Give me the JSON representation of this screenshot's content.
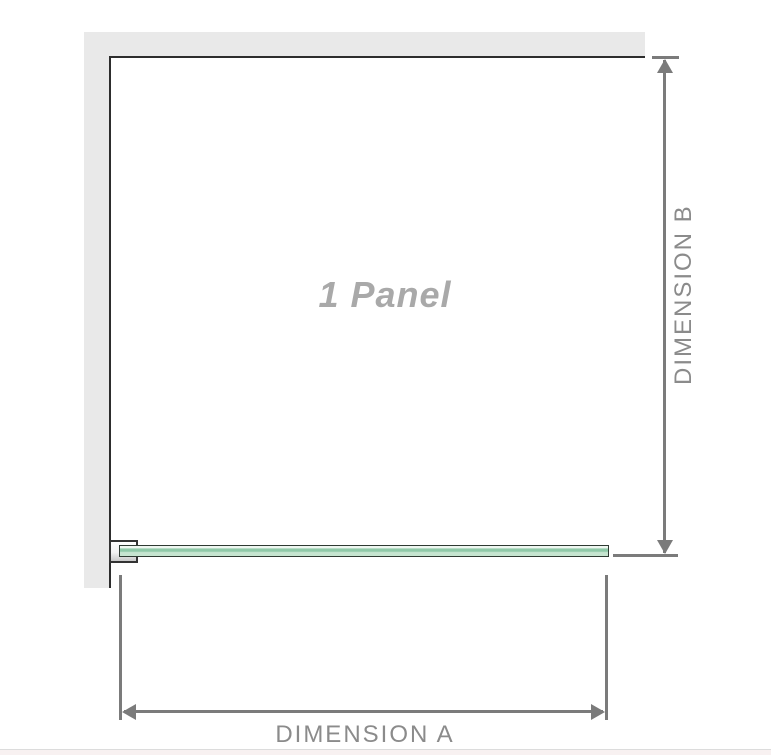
{
  "diagram": {
    "title": "1 Panel shower screen dimension diagram",
    "panel_label": "1 Panel",
    "dimension_a_label": "DIMENSION A",
    "dimension_b_label": "DIMENSION B"
  },
  "colors": {
    "wall": "#e9e9e9",
    "outline": "#2d2d2d",
    "dimline": "#7b7b7b",
    "dimtext": "#8b8b8b",
    "paneltext": "#a9a9a9",
    "glassborder": "#2f3b33",
    "glasspale": "#eff7f1",
    "glassdark": "#8fc9a8",
    "glasslight": "#c6e5d0",
    "stripbg": "#f8f1f1",
    "stripline": "#dcdcdc"
  }
}
